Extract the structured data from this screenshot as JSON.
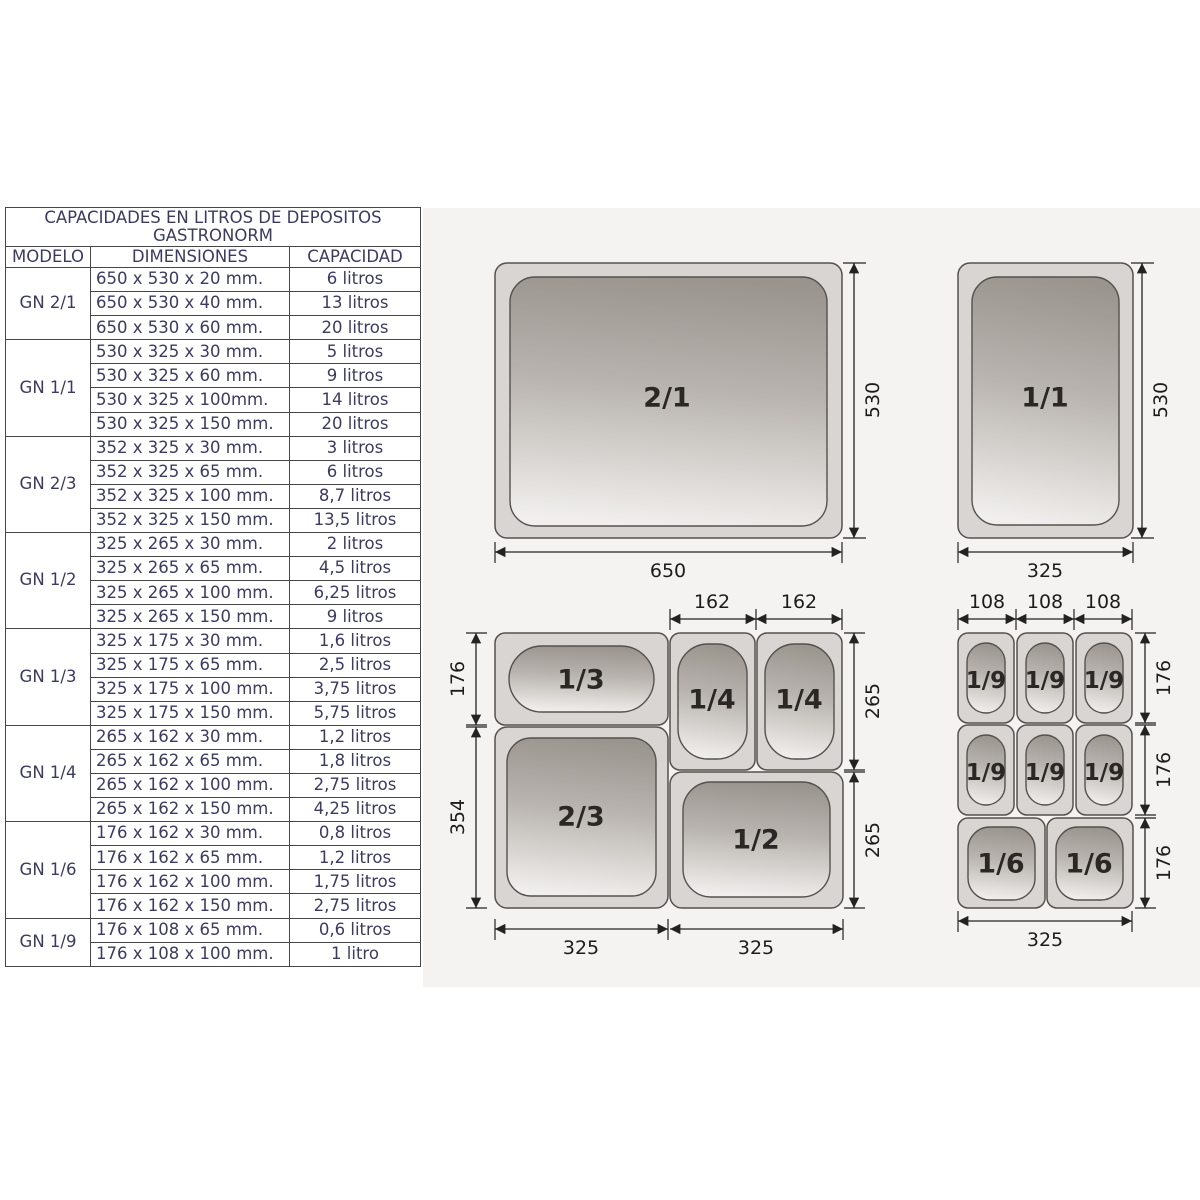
{
  "table": {
    "title_line1": "CAPACIDADES EN LITROS DE DEPOSITOS",
    "title_line2": "GASTRONORM",
    "headers": [
      "MODELO",
      "DIMENSIONES",
      "CAPACIDAD"
    ],
    "groups": [
      {
        "model": "GN 2/1",
        "rows": [
          [
            "650 x 530 x 20 mm.",
            "6 litros"
          ],
          [
            "650 x 530 x 40 mm.",
            "13 litros"
          ],
          [
            "650 x 530 x 60 mm.",
            "20 litros"
          ]
        ]
      },
      {
        "model": "GN 1/1",
        "rows": [
          [
            "530 x 325 x 30 mm.",
            "5 litros"
          ],
          [
            "530 x 325 x 60 mm.",
            "9 litros"
          ],
          [
            "530 x 325 x 100mm.",
            "14 litros"
          ],
          [
            "530 x 325 x 150 mm.",
            "20 litros"
          ]
        ]
      },
      {
        "model": "GN 2/3",
        "rows": [
          [
            "352 x 325 x 30 mm.",
            "3 litros"
          ],
          [
            "352 x 325 x 65 mm.",
            "6 litros"
          ],
          [
            "352 x 325 x 100 mm.",
            "8,7 litros"
          ],
          [
            "352 x 325 x 150 mm.",
            "13,5 litros"
          ]
        ]
      },
      {
        "model": "GN 1/2",
        "rows": [
          [
            "325 x 265 x 30 mm.",
            "2 litros"
          ],
          [
            "325 x 265 x 65 mm.",
            "4,5 litros"
          ],
          [
            "325 x 265 x 100 mm.",
            "6,25 litros"
          ],
          [
            "325 x 265 x 150 mm.",
            "9 litros"
          ]
        ]
      },
      {
        "model": "GN 1/3",
        "rows": [
          [
            "325 x 175 x 30 mm.",
            "1,6 litros"
          ],
          [
            "325 x 175 x 65 mm.",
            "2,5 litros"
          ],
          [
            "325 x 175 x 100 mm.",
            "3,75 litros"
          ],
          [
            "325 x 175 x 150 mm.",
            "5,75 litros"
          ]
        ]
      },
      {
        "model": "GN 1/4",
        "rows": [
          [
            "265 x 162 x 30 mm.",
            "1,2 litros"
          ],
          [
            "265 x 162 x 65 mm.",
            "1,8 litros"
          ],
          [
            "265 x 162 x 100 mm.",
            "2,75 litros"
          ],
          [
            "265 x 162 x 150 mm.",
            "4,25 litros"
          ]
        ]
      },
      {
        "model": "GN 1/6",
        "rows": [
          [
            "176 x 162 x 30 mm.",
            "0,8 litros"
          ],
          [
            "176 x 162 x 65 mm.",
            "1,2 litros"
          ],
          [
            "176 x 162 x 100 mm.",
            "1,75 litros"
          ],
          [
            "176 x 162 x 150 mm.",
            "2,75 litros"
          ]
        ]
      },
      {
        "model": "GN 1/9",
        "rows": [
          [
            "176 x 108 x 65 mm.",
            "0,6 litros"
          ],
          [
            "176 x 108 x 100 mm.",
            "1 litro"
          ]
        ]
      }
    ]
  },
  "diagrams": {
    "colors": {
      "panel_bg": "#f5f3f1",
      "pan_shell": "#d8d5d2",
      "pan_stroke": "#56514c",
      "gradient_top": "#9a948f",
      "gradient_bottom": "#f1efed",
      "table_text": "#3b3b62"
    },
    "gn21": {
      "label": "2/1",
      "dim_w": "650",
      "dim_h": "530"
    },
    "gn11": {
      "label": "1/1",
      "dim_w": "325",
      "dim_h": "530"
    },
    "left_group": {
      "pan_13": "1/3",
      "pan_14a": "1/4",
      "pan_14b": "1/4",
      "pan_23": "2/3",
      "pan_12": "1/2",
      "dim_176": "176",
      "dim_354": "354",
      "dim_162a": "162",
      "dim_162b": "162",
      "dim_265a": "265",
      "dim_265b": "265",
      "dim_325a": "325",
      "dim_325b": "325"
    },
    "right_group": {
      "pans_19": [
        "1/9",
        "1/9",
        "1/9",
        "1/9",
        "1/9",
        "1/9"
      ],
      "pans_16": [
        "1/6",
        "1/6"
      ],
      "dims_108": [
        "108",
        "108",
        "108"
      ],
      "dims_176": [
        "176",
        "176",
        "176"
      ],
      "dim_325": "325"
    }
  }
}
